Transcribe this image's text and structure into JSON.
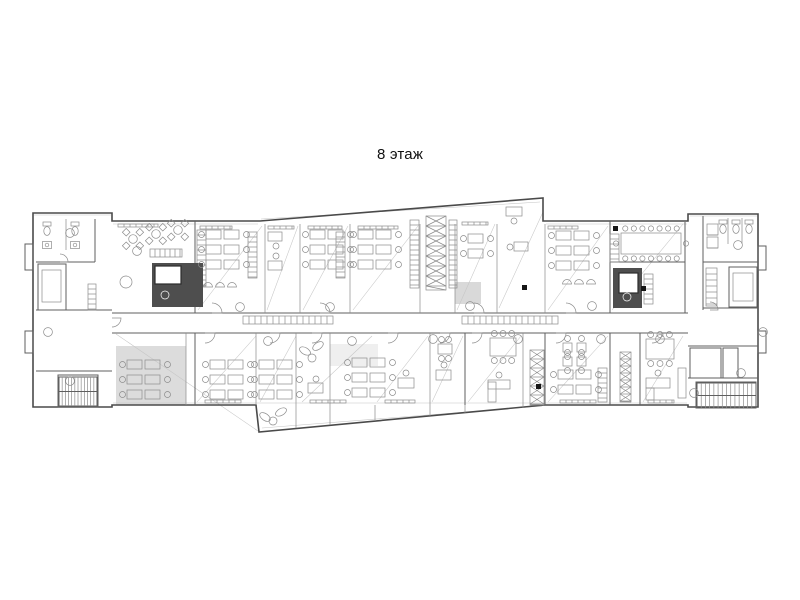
{
  "title": "8 этаж",
  "colors": {
    "background": "#ffffff",
    "line_strong": "#4a4a4a",
    "line_medium": "#5f5f5f",
    "line_thin": "#8c8c8c",
    "line_faint": "#c6c6c6",
    "core_fill": "#4e4e4e",
    "grey_room": "#dcdcdc",
    "bench_fill": "#cfcfcf",
    "marker": "#161616"
  },
  "plan": {
    "outline": [
      [
        33,
        213
      ],
      [
        112,
        213
      ],
      [
        112,
        221
      ],
      [
        260,
        221
      ],
      [
        543,
        198
      ],
      [
        543,
        221
      ],
      [
        688,
        221
      ],
      [
        688,
        214
      ],
      [
        758,
        214
      ],
      [
        758,
        407
      ],
      [
        688,
        407
      ],
      [
        688,
        405
      ],
      [
        545,
        405
      ],
      [
        259,
        432
      ],
      [
        256,
        405
      ],
      [
        112,
        405
      ],
      [
        112,
        407
      ],
      [
        33,
        407
      ]
    ],
    "bumpouts": [
      [
        25,
        244,
        8,
        26
      ],
      [
        25,
        331,
        8,
        22
      ],
      [
        758,
        246,
        8,
        24
      ],
      [
        758,
        331,
        8,
        22
      ]
    ],
    "grey_rooms": [
      [
        116,
        346,
        70,
        59,
        "#dcdcdc"
      ],
      [
        455,
        282,
        26,
        22,
        "#d9d9d9"
      ],
      [
        330,
        344,
        48,
        22,
        "#efefef"
      ]
    ],
    "walls_main": [
      [
        112,
        313,
        688,
        313
      ],
      [
        112,
        333,
        688,
        333
      ],
      [
        95,
        219,
        95,
        262
      ],
      [
        36,
        262,
        95,
        262
      ],
      [
        36,
        310,
        112,
        310
      ],
      [
        36,
        371,
        112,
        371
      ],
      [
        195,
        221,
        195,
        313
      ],
      [
        610,
        221,
        610,
        313
      ],
      [
        685,
        222,
        685,
        313
      ],
      [
        610,
        262,
        685,
        262
      ],
      [
        703,
        216,
        703,
        310
      ],
      [
        703,
        262,
        758,
        262
      ],
      [
        703,
        308,
        758,
        308
      ],
      [
        688,
        346,
        758,
        346
      ],
      [
        688,
        378,
        758,
        378
      ],
      [
        195,
        333,
        195,
        405
      ],
      [
        465,
        333,
        465,
        405
      ],
      [
        545,
        333,
        545,
        405
      ],
      [
        610,
        333,
        610,
        405
      ],
      [
        640,
        333,
        640,
        405
      ]
    ],
    "rects_main": [
      [
        38,
        264,
        28,
        46
      ],
      [
        58,
        375,
        40,
        32
      ],
      [
        729,
        267,
        28,
        40
      ],
      [
        696,
        382,
        60,
        26
      ],
      [
        690,
        348,
        31,
        30
      ],
      [
        723,
        348,
        15,
        30
      ]
    ],
    "walls_thin": [
      [
        265,
        224,
        265,
        313
      ],
      [
        300,
        224,
        300,
        313
      ],
      [
        350,
        224,
        350,
        313
      ],
      [
        420,
        224,
        420,
        313
      ],
      [
        455,
        224,
        455,
        313
      ],
      [
        497,
        224,
        497,
        313
      ],
      [
        545,
        224,
        545,
        313
      ],
      [
        186,
        333,
        186,
        405
      ],
      [
        256,
        333,
        256,
        405
      ],
      [
        296,
        333,
        296,
        405
      ],
      [
        330,
        333,
        330,
        405
      ],
      [
        430,
        333,
        430,
        405
      ],
      [
        523,
        333,
        523,
        405
      ],
      [
        66,
        219,
        66,
        250
      ],
      [
        728,
        218,
        728,
        244
      ],
      [
        742,
        218,
        742,
        244
      ],
      [
        296,
        405,
        296,
        428
      ],
      [
        330,
        405,
        330,
        425
      ],
      [
        375,
        405,
        375,
        421
      ],
      [
        430,
        405,
        430,
        416
      ],
      [
        465,
        405,
        465,
        413
      ],
      [
        523,
        405,
        523,
        408
      ]
    ],
    "rects_thin": [
      [
        42,
        270,
        19,
        32
      ],
      [
        733,
        273,
        20,
        28
      ],
      [
        488,
        382,
        8,
        20
      ],
      [
        646,
        388,
        8,
        12
      ],
      [
        678,
        368,
        8,
        30
      ]
    ],
    "diagonals": [
      [
        198,
        310,
        262,
        226
      ],
      [
        267,
        310,
        298,
        226
      ],
      [
        303,
        310,
        348,
        226
      ],
      [
        353,
        310,
        418,
        226
      ],
      [
        457,
        310,
        495,
        224
      ],
      [
        499,
        308,
        543,
        212
      ],
      [
        548,
        310,
        608,
        226
      ],
      [
        612,
        310,
        683,
        224
      ],
      [
        197,
        402,
        256,
        336
      ],
      [
        260,
        402,
        296,
        336
      ],
      [
        302,
        402,
        372,
        336
      ],
      [
        377,
        402,
        428,
        336
      ],
      [
        432,
        402,
        463,
        336
      ],
      [
        468,
        402,
        521,
        336
      ],
      [
        548,
        402,
        608,
        336
      ],
      [
        643,
        402,
        683,
        336
      ],
      [
        261,
        219,
        540,
        202
      ],
      [
        262,
        428,
        542,
        406
      ],
      [
        116,
        334,
        258,
        431
      ],
      [
        113,
        224,
        258,
        224
      ],
      [
        546,
        224,
        687,
        224
      ],
      [
        113,
        403,
        687,
        403
      ],
      [
        690,
        216,
        757,
        216
      ],
      [
        34,
        215,
        111,
        215
      ]
    ],
    "hatches": [
      [
        197,
        230,
        9,
        56,
        5,
        "y",
        0,
        ""
      ],
      [
        248,
        232,
        9,
        46,
        5,
        "y",
        0,
        ""
      ],
      [
        336,
        232,
        9,
        46,
        5,
        "y",
        0,
        ""
      ],
      [
        410,
        220,
        9,
        68,
        5,
        "y",
        0,
        ""
      ],
      [
        449,
        220,
        8,
        68,
        5,
        "y",
        0,
        ""
      ],
      [
        426,
        216,
        20,
        74,
        10,
        "y",
        1,
        ""
      ],
      [
        530,
        350,
        14,
        55,
        9,
        "y",
        1,
        ""
      ],
      [
        620,
        352,
        11,
        50,
        7,
        "y",
        1,
        ""
      ],
      [
        598,
        368,
        9,
        34,
        5,
        "y",
        0,
        ""
      ],
      [
        706,
        268,
        11,
        38,
        6,
        "y",
        0,
        ""
      ],
      [
        644,
        274,
        9,
        30,
        5,
        "y",
        0,
        ""
      ],
      [
        88,
        284,
        8,
        26,
        5,
        "y",
        0,
        ""
      ],
      [
        610,
        234,
        9,
        28,
        5,
        "y",
        0,
        ""
      ],
      [
        150,
        249,
        32,
        8,
        5,
        "x",
        0,
        ""
      ],
      [
        243,
        316,
        90,
        8,
        6,
        "x",
        0,
        "#cfcfcf"
      ],
      [
        462,
        316,
        96,
        8,
        6,
        "x",
        0,
        "#cfcfcf"
      ],
      [
        707,
        224,
        11,
        11,
        11,
        "y",
        1,
        ""
      ],
      [
        707,
        237,
        11,
        11,
        11,
        "y",
        1,
        ""
      ],
      [
        200,
        226,
        32,
        3,
        6,
        "x",
        0,
        ""
      ],
      [
        268,
        226,
        26,
        3,
        6,
        "x",
        0,
        ""
      ],
      [
        308,
        226,
        34,
        3,
        6,
        "x",
        0,
        ""
      ],
      [
        358,
        226,
        40,
        3,
        6,
        "x",
        0,
        ""
      ],
      [
        462,
        222,
        26,
        3,
        6,
        "x",
        0,
        ""
      ],
      [
        548,
        226,
        30,
        3,
        6,
        "x",
        0,
        ""
      ],
      [
        118,
        224,
        40,
        3,
        6,
        "x",
        0,
        ""
      ],
      [
        205,
        400,
        36,
        3,
        6,
        "x",
        0,
        ""
      ],
      [
        310,
        400,
        36,
        3,
        6,
        "x",
        0,
        ""
      ],
      [
        385,
        400,
        30,
        3,
        6,
        "x",
        0,
        ""
      ],
      [
        560,
        400,
        36,
        3,
        6,
        "x",
        0,
        ""
      ],
      [
        648,
        400,
        26,
        3,
        6,
        "x",
        0,
        ""
      ]
    ],
    "stairs": [
      [
        59,
        377,
        38,
        29,
        12
      ],
      [
        697,
        383,
        59,
        25,
        14
      ]
    ],
    "cores": [
      {
        "rect": [
          152,
          263,
          51,
          44
        ],
        "inner": [
          155,
          266,
          26,
          18
        ],
        "dot": [
          165,
          295
        ]
      },
      {
        "rect": [
          613,
          268,
          29,
          40
        ],
        "inner": [
          619,
          273,
          19,
          20
        ],
        "dot": [
          627,
          297
        ]
      }
    ],
    "clusters": [
      [
        206,
        230,
        3,
        2
      ],
      [
        310,
        230,
        3,
        2
      ],
      [
        358,
        230,
        3,
        2
      ],
      [
        556,
        231,
        3,
        2
      ],
      [
        468,
        234,
        2,
        1
      ],
      [
        127,
        360,
        3,
        2
      ],
      [
        210,
        360,
        3,
        2
      ],
      [
        259,
        360,
        3,
        2
      ],
      [
        352,
        358,
        3,
        2
      ],
      [
        558,
        370,
        2,
        2
      ]
    ],
    "desks": [
      [
        506,
        207,
        16,
        9,
        514,
        221
      ],
      [
        514,
        242,
        14,
        9,
        510,
        247
      ],
      [
        268,
        232,
        14,
        9,
        276,
        246
      ],
      [
        268,
        261,
        14,
        9,
        276,
        256
      ],
      [
        308,
        383,
        15,
        10,
        316,
        379
      ],
      [
        398,
        378,
        16,
        10,
        406,
        373
      ],
      [
        436,
        370,
        15,
        10,
        444,
        365
      ],
      [
        488,
        380,
        22,
        9,
        499,
        375
      ],
      [
        646,
        378,
        24,
        10,
        658,
        373
      ]
    ],
    "meetings": [
      [
        490,
        338,
        26,
        18,
        3,
        3
      ],
      [
        646,
        339,
        28,
        20,
        3,
        3
      ],
      [
        438,
        344,
        14,
        10,
        2,
        2
      ],
      [
        563,
        343,
        9,
        9,
        1,
        1
      ],
      [
        577,
        343,
        9,
        9,
        1,
        1
      ],
      [
        563,
        357,
        9,
        9,
        1,
        1
      ],
      [
        577,
        357,
        9,
        9,
        1,
        1
      ]
    ],
    "conference": {
      "rect": [
        621,
        233,
        60,
        21
      ],
      "chairs_top": 7,
      "chairs_bottom": 7
    },
    "xtables": [
      [
        133,
        239
      ],
      [
        156,
        234
      ],
      [
        178,
        230
      ]
    ],
    "round_tables": [
      [
        126,
        282,
        6
      ],
      [
        312,
        358,
        4
      ],
      [
        273,
        421,
        4
      ]
    ],
    "shells": [
      [
        208,
        287
      ],
      [
        220,
        287
      ],
      [
        232,
        287
      ],
      [
        567,
        284
      ],
      [
        579,
        284
      ],
      [
        591,
        284
      ]
    ],
    "toilets": [
      [
        47,
        230
      ],
      [
        75,
        230
      ],
      [
        723,
        228
      ],
      [
        736,
        228
      ],
      [
        749,
        228
      ]
    ],
    "sinks": [
      [
        47,
        245
      ],
      [
        75,
        245
      ]
    ],
    "leaves": [
      [
        305,
        351,
        30
      ],
      [
        318,
        346,
        -35
      ],
      [
        265,
        417,
        35
      ],
      [
        281,
        412,
        -30
      ]
    ],
    "door_arcs": [
      [
        205,
        333,
        10,
        1
      ],
      [
        270,
        333,
        10,
        1
      ],
      [
        312,
        333,
        10,
        1
      ],
      [
        388,
        333,
        10,
        1
      ],
      [
        440,
        333,
        10,
        1
      ],
      [
        472,
        333,
        10,
        1
      ],
      [
        556,
        333,
        10,
        1
      ],
      [
        652,
        333,
        10,
        1
      ],
      [
        212,
        313,
        10,
        0
      ],
      [
        320,
        313,
        10,
        0
      ],
      [
        474,
        313,
        10,
        0
      ],
      [
        566,
        313,
        10,
        0
      ],
      [
        112,
        318,
        9,
        1
      ],
      [
        60,
        262,
        8,
        0
      ],
      [
        710,
        310,
        8,
        0
      ]
    ],
    "grid_circles": [
      [
        70,
        233
      ],
      [
        48,
        332
      ],
      [
        70,
        381
      ],
      [
        137,
        251
      ],
      [
        738,
        245
      ],
      [
        763,
        332
      ],
      [
        741,
        373
      ],
      [
        694,
        393
      ],
      [
        268,
        341
      ],
      [
        352,
        341
      ],
      [
        433,
        339
      ],
      [
        518,
        339
      ],
      [
        601,
        339
      ],
      [
        660,
        339
      ],
      [
        240,
        307
      ],
      [
        330,
        307
      ],
      [
        470,
        306
      ],
      [
        592,
        306
      ]
    ],
    "markers": [
      [
        522,
        285
      ],
      [
        641,
        286
      ],
      [
        613,
        226
      ],
      [
        536,
        384
      ]
    ]
  }
}
